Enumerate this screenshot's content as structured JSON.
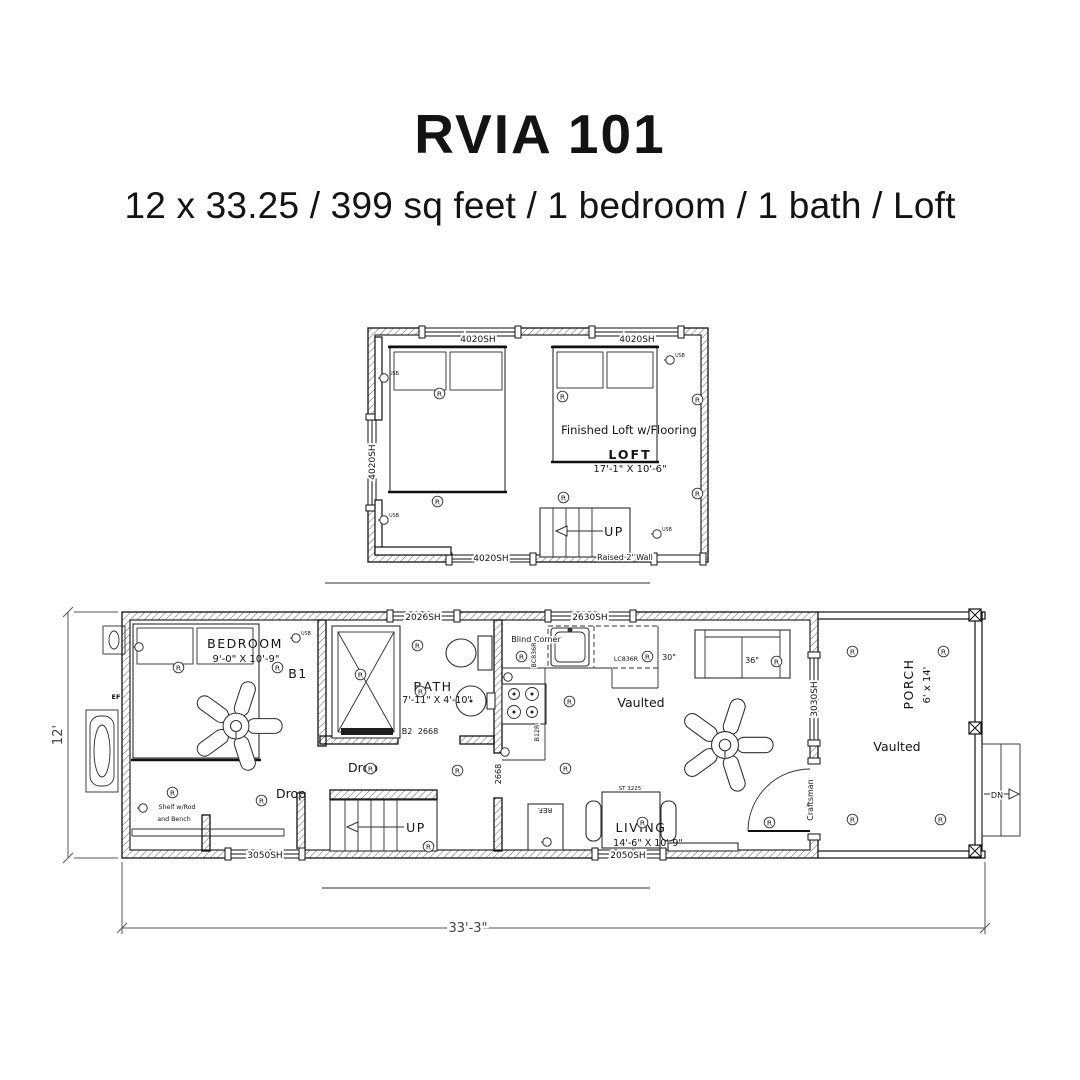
{
  "colors": {
    "ink": "#131313",
    "wall_line": "#111111",
    "dim_line": "#555555",
    "background": "#ffffff"
  },
  "header": {
    "title": "RVIA 101",
    "subtitle": "12 x 33.25 / 399 sq feet / 1 bedroom / 1 bath / Loft"
  },
  "symbols": {
    "recessed_light": "R",
    "usb": "USB"
  },
  "loft": {
    "note": "Finished Loft w/Flooring",
    "room": "LOFT",
    "dims": "17'-1\" X 10'-6\"",
    "stairs": "UP",
    "raised_wall": "Raised 2' Wall",
    "window_top_left": "4020SH",
    "window_top_right": "4020SH",
    "window_left": "4020SH",
    "window_bottom": "4020SH"
  },
  "main": {
    "bedroom": {
      "name": "BEDROOM",
      "dims": "9'-0\" X 10'-9\"",
      "door_tag": "B1"
    },
    "closet": {
      "shelf1": "Shelf w/Rod",
      "shelf2": "and Bench",
      "drop": "Drop"
    },
    "hall": {
      "drop": "Drop",
      "stairs": "UP"
    },
    "bath": {
      "name": "BATH",
      "dims": "7'-11\" X 4'-10\"",
      "door_tag": "B2",
      "door_size": "2668"
    },
    "kitchen": {
      "blind_corner": "Blind Corner",
      "corner_cab": "BC836R",
      "upper_cab": "LC836R",
      "upper_width": "30\"",
      "base_cab": "B12R",
      "fridge": "REF.",
      "door_size": "2668",
      "vaulted": "Vaulted"
    },
    "living": {
      "name": "LIVING",
      "dims": "14'-6\" X 10'-9\"",
      "sofa": "36\"",
      "table": "ST 3225",
      "front_door": "Craftsman"
    },
    "porch": {
      "name": "PORCH",
      "dims": "6' x 14'",
      "vaulted": "Vaulted",
      "steps": "DN"
    },
    "exhaust_fan": "EF",
    "windows": {
      "w1": "3050SH",
      "w2": "2026SH",
      "w3": "2630SH",
      "w4": "3030SH",
      "w5": "2050SH"
    },
    "overall": {
      "width": "33'-3\"",
      "height": "12'"
    }
  }
}
